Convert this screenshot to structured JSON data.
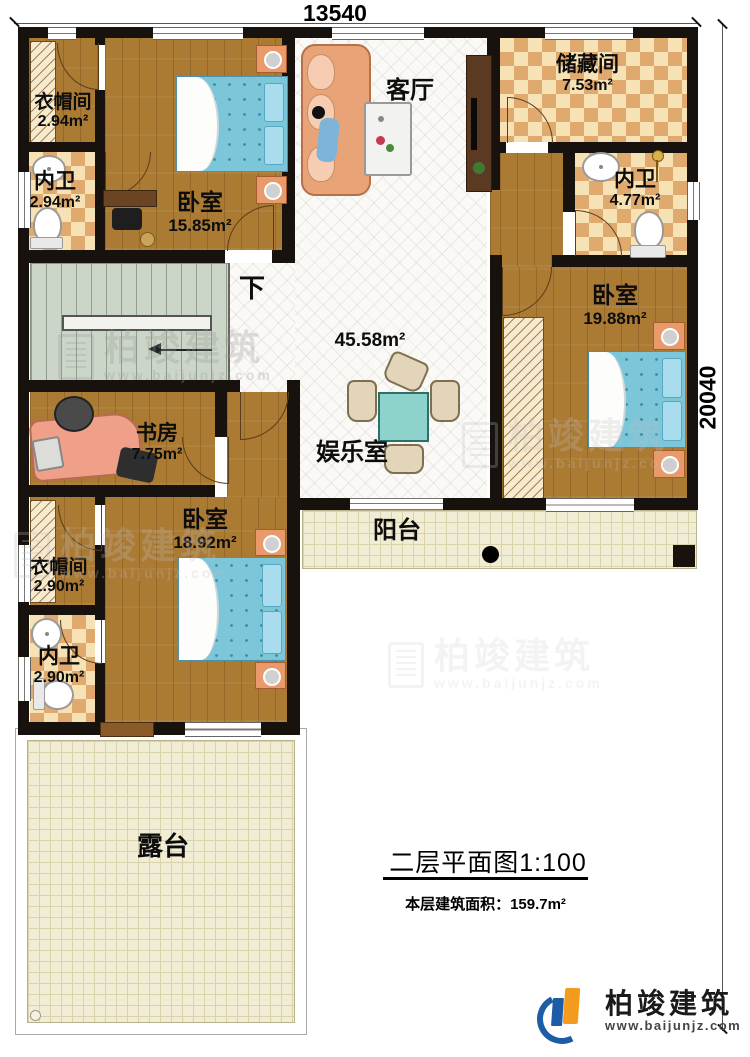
{
  "dimensions": {
    "top": "13540",
    "right": "20040"
  },
  "stairs": {
    "direction_label": "下"
  },
  "hall": {
    "area": "45.58m²"
  },
  "rooms": {
    "cloakroom_top": {
      "name": "衣帽间",
      "area": "2.94m²"
    },
    "bath_top": {
      "name": "内卫",
      "area": "2.94m²"
    },
    "bedroom_top": {
      "name": "卧室",
      "area": "15.85m²"
    },
    "living": {
      "name": "客厅"
    },
    "storage": {
      "name": "储藏间",
      "area": "7.53m²"
    },
    "bath_right": {
      "name": "内卫",
      "area": "4.77m²"
    },
    "bedroom_right": {
      "name": "卧室",
      "area": "19.88m²"
    },
    "study": {
      "name": "书房",
      "area": "7.75m²"
    },
    "game_room": {
      "name": "娱乐室"
    },
    "bedroom_bottom": {
      "name": "卧室",
      "area": "18.92m²"
    },
    "cloakroom_bottom": {
      "name": "衣帽间",
      "area": "2.90m²"
    },
    "bath_bottom": {
      "name": "内卫",
      "area": "2.90m²"
    },
    "balcony": {
      "name": "阳台"
    },
    "terrace": {
      "name": "露台"
    }
  },
  "titleblock": {
    "title": "二层平面图1:100",
    "subtitle": "本层建筑面积：159.7m²"
  },
  "brand": {
    "name": "柏竣建筑",
    "url": "www.baijunjz.com"
  },
  "watermark": {
    "name": "柏竣建筑",
    "url": "www.baijunjz.com"
  },
  "palette": {
    "wall": "#17120d",
    "wood": "#ab7a33",
    "tile": "#faf9f6",
    "checker_light": "#f6e2b4",
    "checker_dark": "#e0aa6f",
    "stair": "#ccd6c8",
    "deck": "#f1edd5",
    "bed": "#7cc6da",
    "logo_blue": "#1d5ca6",
    "logo_orange": "#f29b1d"
  }
}
